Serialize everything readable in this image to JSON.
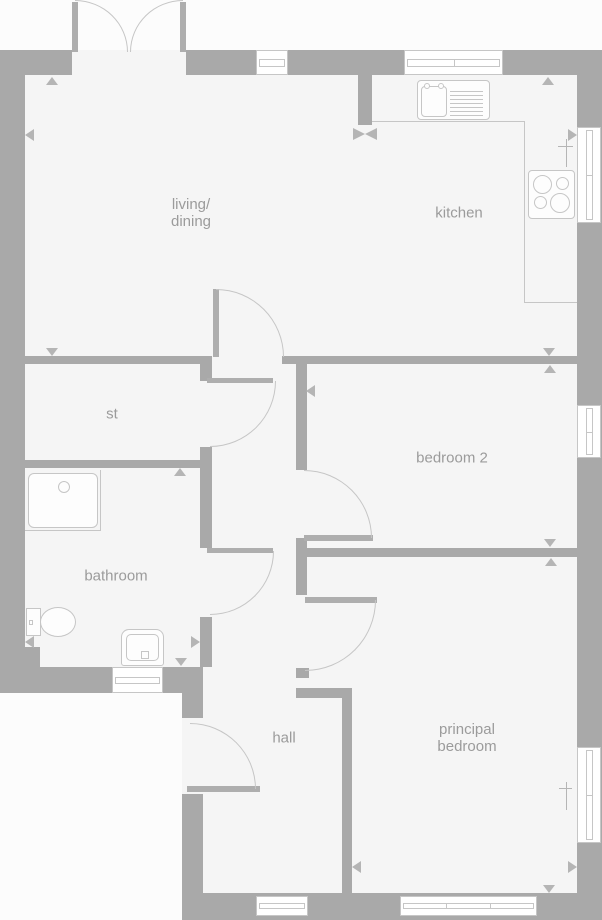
{
  "title": "floor plan",
  "colors": {
    "page": "#fcfcfc",
    "floor": "#f5f5f5",
    "wall": "#a9a9a9",
    "line": "#c6c6c6",
    "leaf": "#aeaeae",
    "marker": "#b5b5b5",
    "text": "#9b9b9b"
  },
  "rooms": {
    "living_dining": {
      "line1": "living/",
      "line2": "dining"
    },
    "kitchen": {
      "label": "kitchen"
    },
    "st": {
      "label": "st"
    },
    "bathroom": {
      "label": "bathroom"
    },
    "bedroom2": {
      "label": "bedroom 2"
    },
    "hall": {
      "label": "hall"
    },
    "principal": {
      "line1": "principal",
      "line2": "bedroom"
    }
  },
  "icons": [
    "french-doors-icon",
    "front-door-icon",
    "interior-door-icon",
    "window-icon",
    "sink-drainer-icon",
    "hob-icon",
    "tap-cross-icon",
    "shower-tray-icon",
    "toilet-icon",
    "basin-icon",
    "dimension-arrow-icon"
  ]
}
